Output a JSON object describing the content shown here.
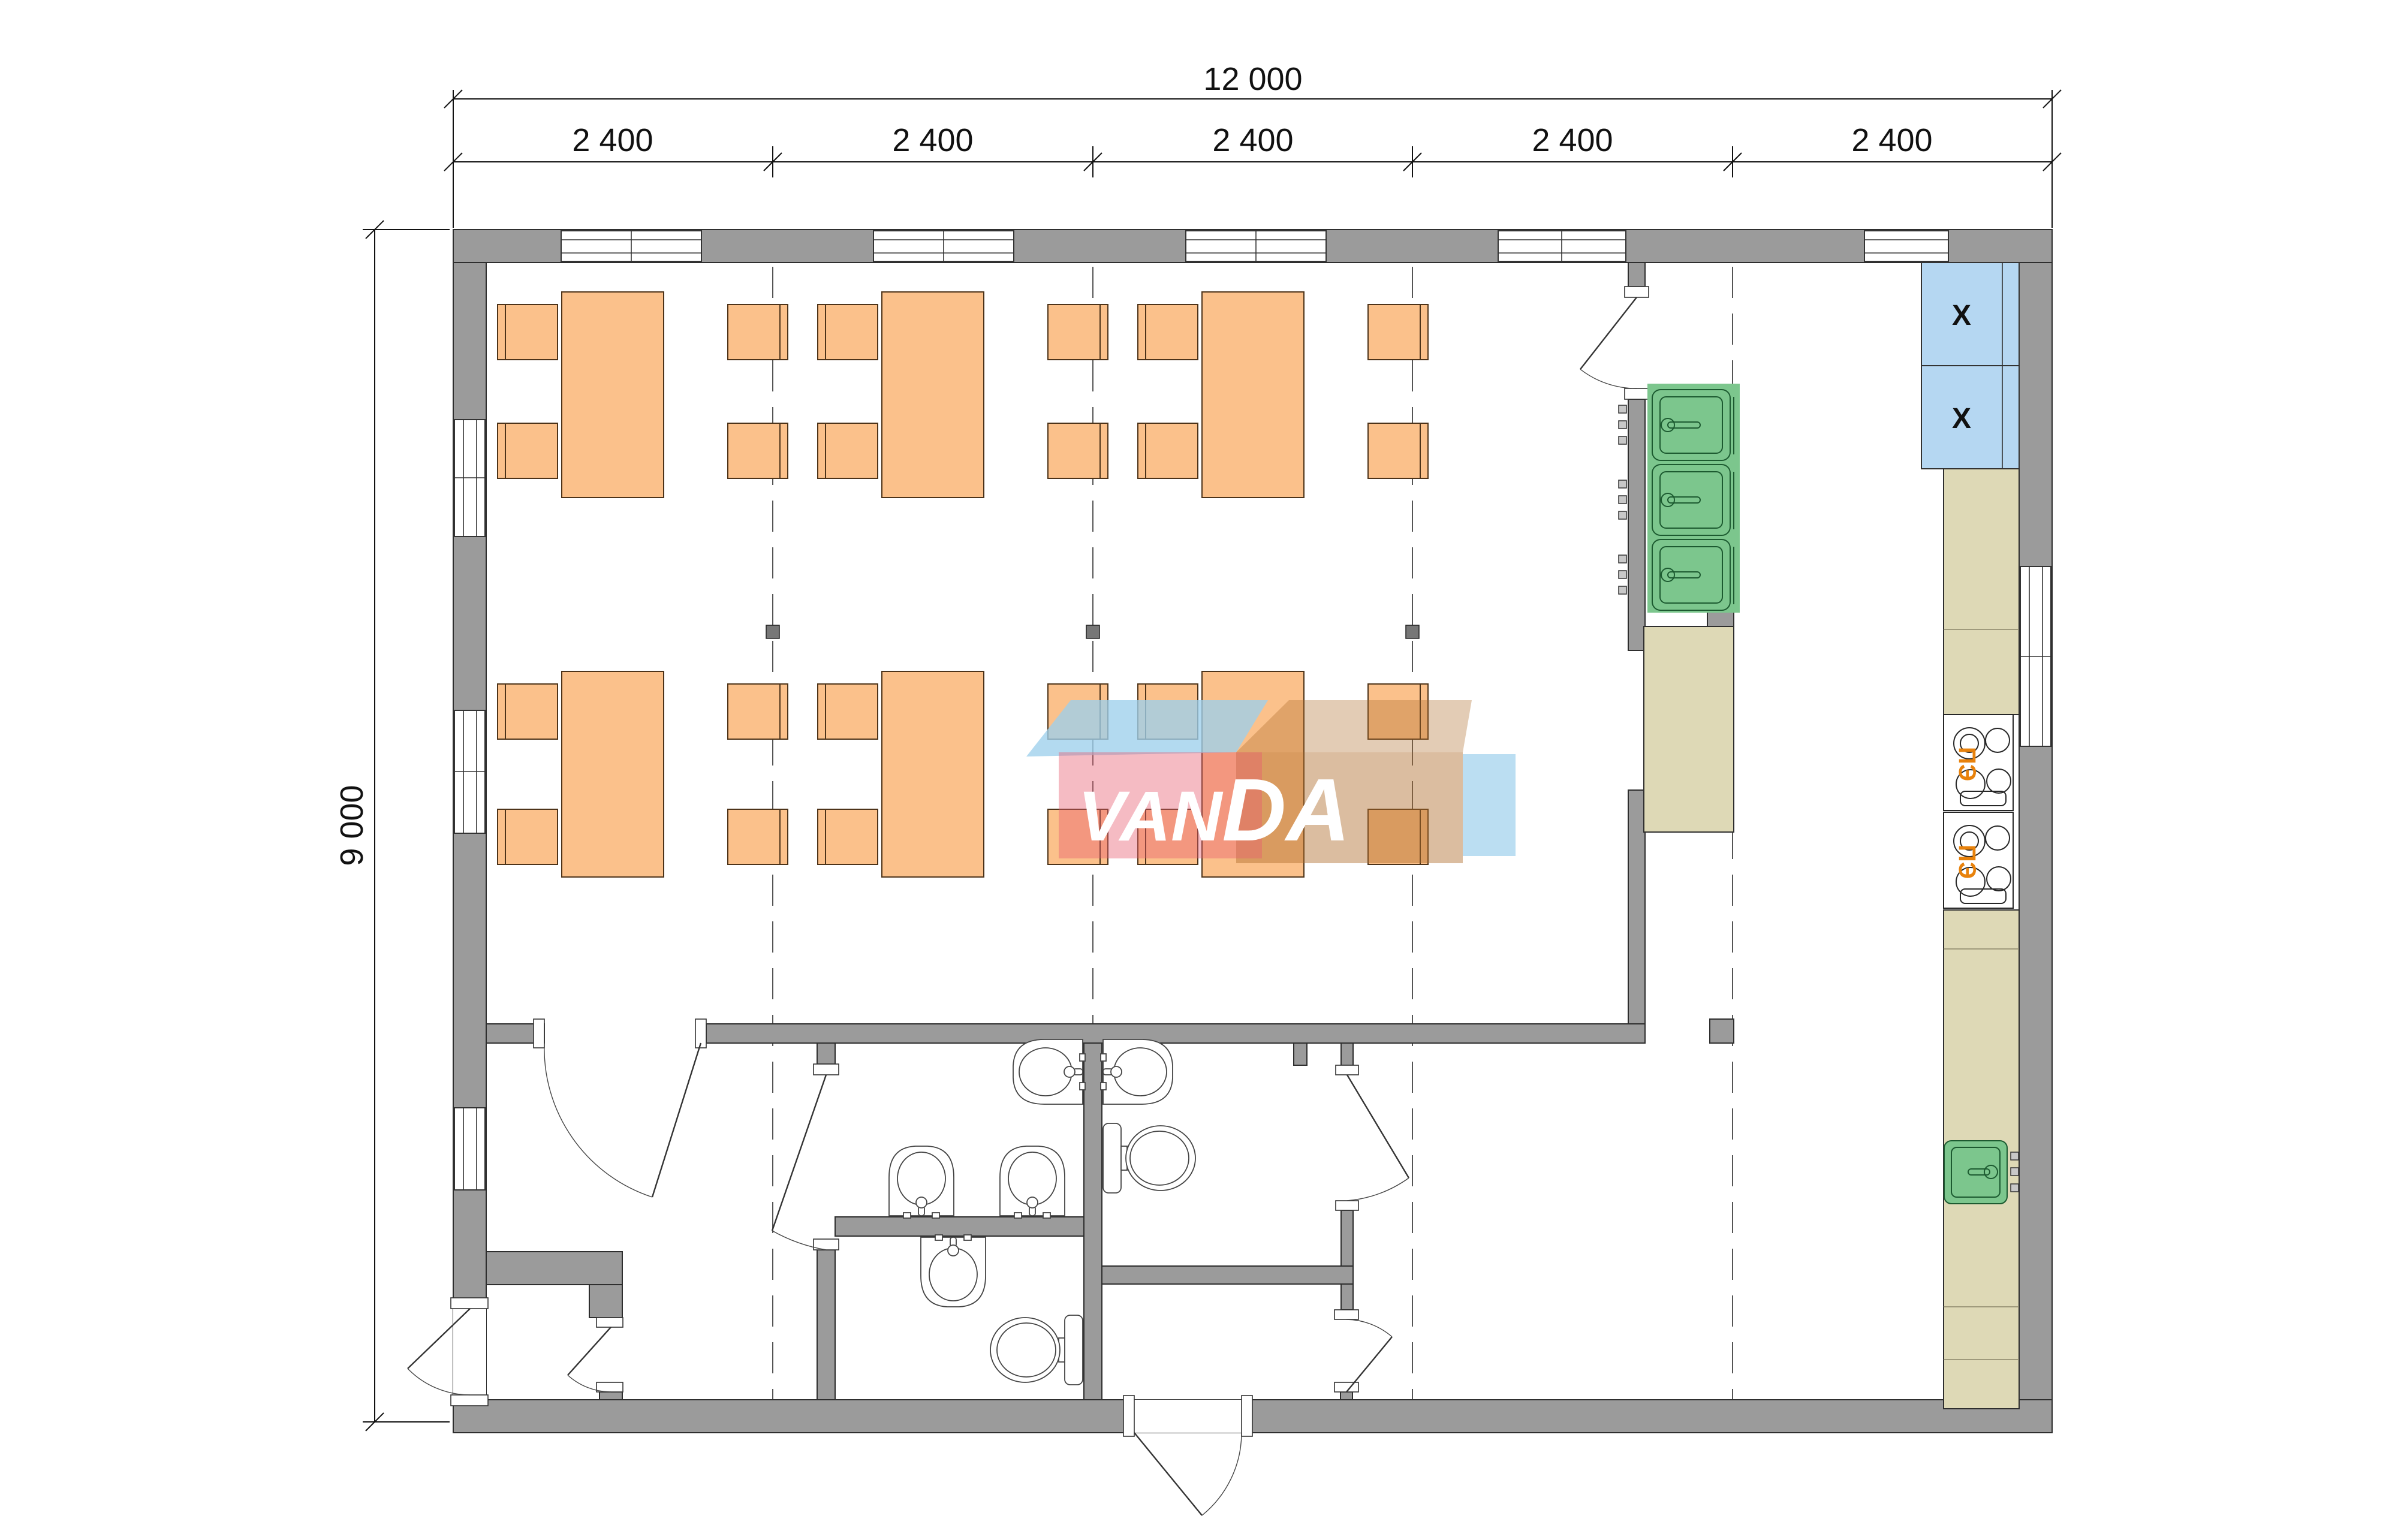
{
  "drawing": {
    "type": "floor-plan",
    "description": "Canteen / dining hall module floor plan with kitchen and sanitary rooms"
  },
  "dimensions": {
    "overall_width_label": "12 000",
    "overall_height_label": "9 000",
    "bay_labels": [
      "2 400",
      "2 400",
      "2 400",
      "2 400",
      "2 400"
    ]
  },
  "equipment_labels": {
    "stove_top": "ПЭ",
    "stove_bottom": "ПЭ",
    "cabinet_top_mark": "X",
    "cabinet_bottom_mark": "X"
  },
  "watermark": {
    "text_left": "VAN",
    "text_right": "DA"
  },
  "colors": {
    "wall": "#9b9b9b",
    "table": "#FBC18B",
    "sink_green": "#7CC68D",
    "counter_beige": "#DED9B6",
    "cabinet_blue": "#B5D7F2",
    "stove_dark": "#6b6b6b",
    "stove_label_orange": "#E8820C",
    "watermark_pink": "#E85D71",
    "watermark_blue": "#9ED0EC",
    "watermark_brown": "#B06C2C"
  }
}
